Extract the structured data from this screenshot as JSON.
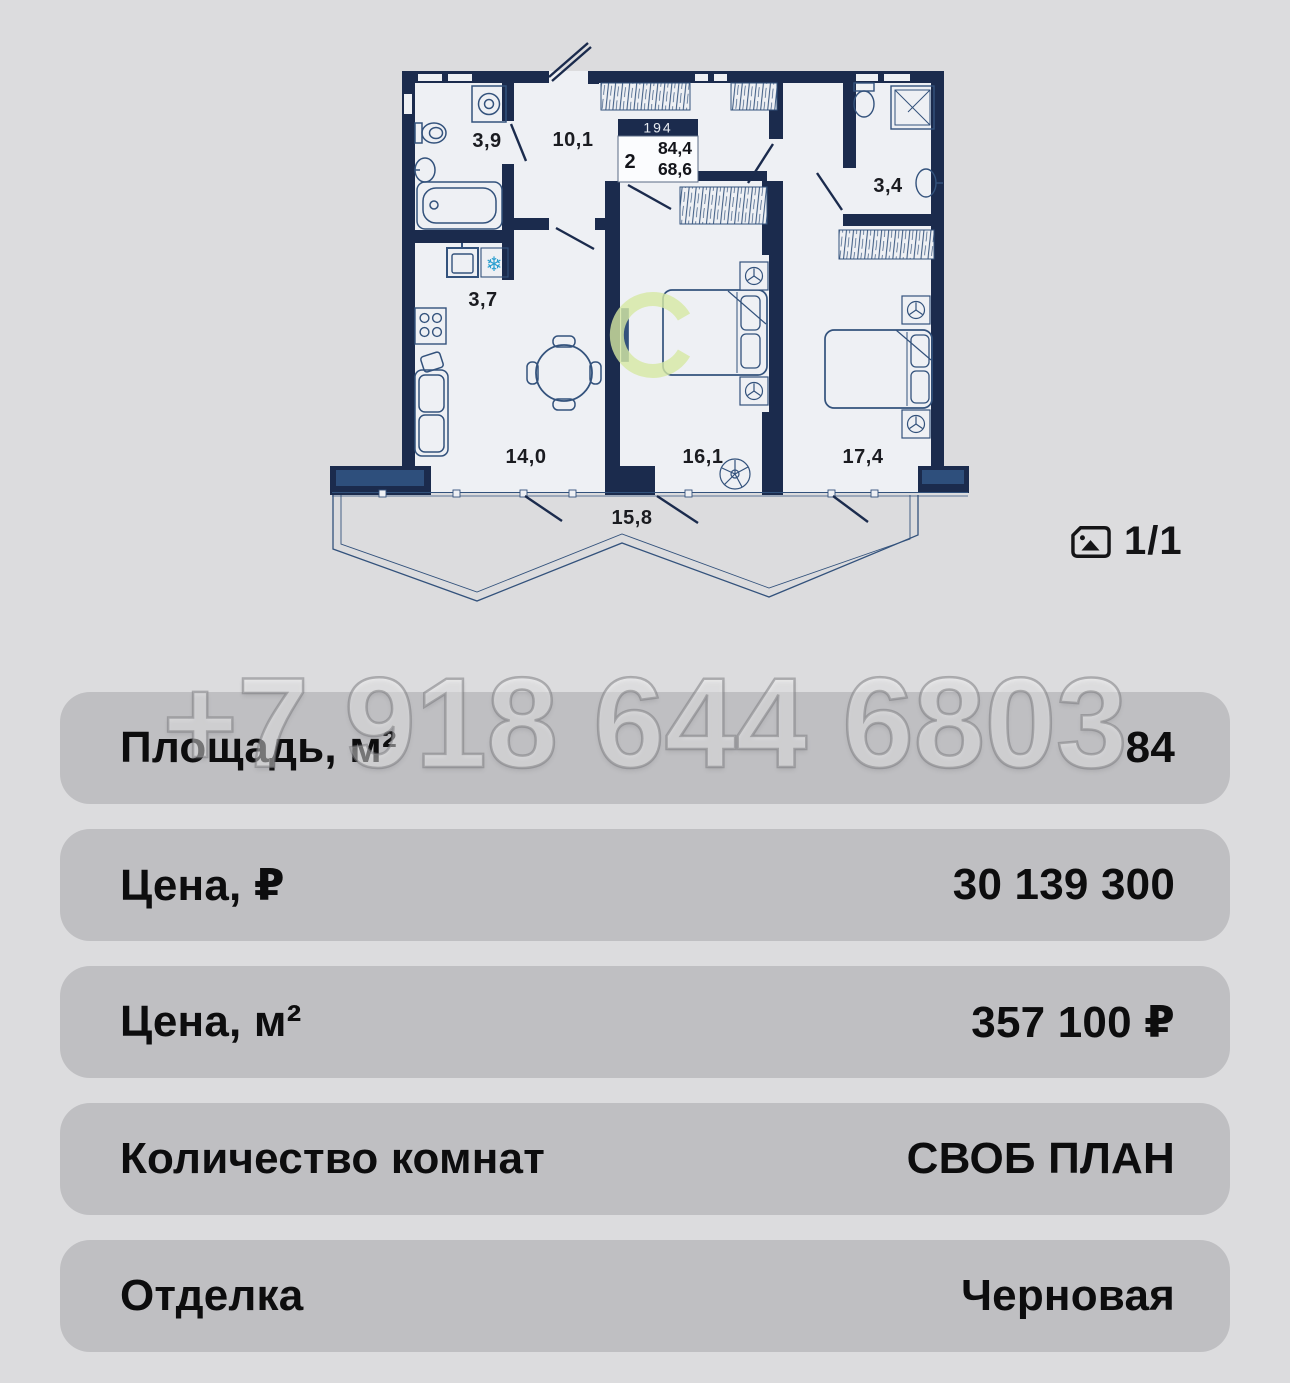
{
  "colors": {
    "page_bg": "#dcdcde",
    "row_bg": "#bfbfc2",
    "ink": "#0d0d0e",
    "wall": "#1b2b4d",
    "wall_light": "#2e4f7c",
    "plan_bg": "#eef0f4",
    "line": "#33527c",
    "accent": "#2a9fd0",
    "logo": "#d6e8a2",
    "plan_label": "#1a1b20",
    "wm_fill": "rgba(255,255,255,0.40)",
    "wm_stroke": "rgba(125,125,130,0.55)"
  },
  "floor_plan": {
    "unit_badge": "194",
    "rooms_count": "2",
    "area_total": "84,4",
    "area_living": "68,6",
    "areas": {
      "bathroom": "3,9",
      "hallway": "10,1",
      "kitchen": "3,7",
      "living_room": "14,0",
      "bedroom_1": "16,1",
      "bedroom_2": "17,4",
      "bathroom_2": "3,4",
      "balcony": "15,8"
    }
  },
  "icons": {
    "snowflake": "❄"
  },
  "photo_counter": {
    "label": "1/1"
  },
  "watermark": {
    "phone": "+7 918 644 6803"
  },
  "details": {
    "rows": [
      {
        "label": "Площадь, м²",
        "value": "84"
      },
      {
        "label": "Цена, ₽",
        "value": "30 139 300"
      },
      {
        "label": "Цена, м²",
        "value": "357 100 ₽"
      },
      {
        "label": "Количество комнат",
        "value": "СВОБ ПЛАН"
      },
      {
        "label": "Отделка",
        "value": "Черновая"
      }
    ]
  }
}
